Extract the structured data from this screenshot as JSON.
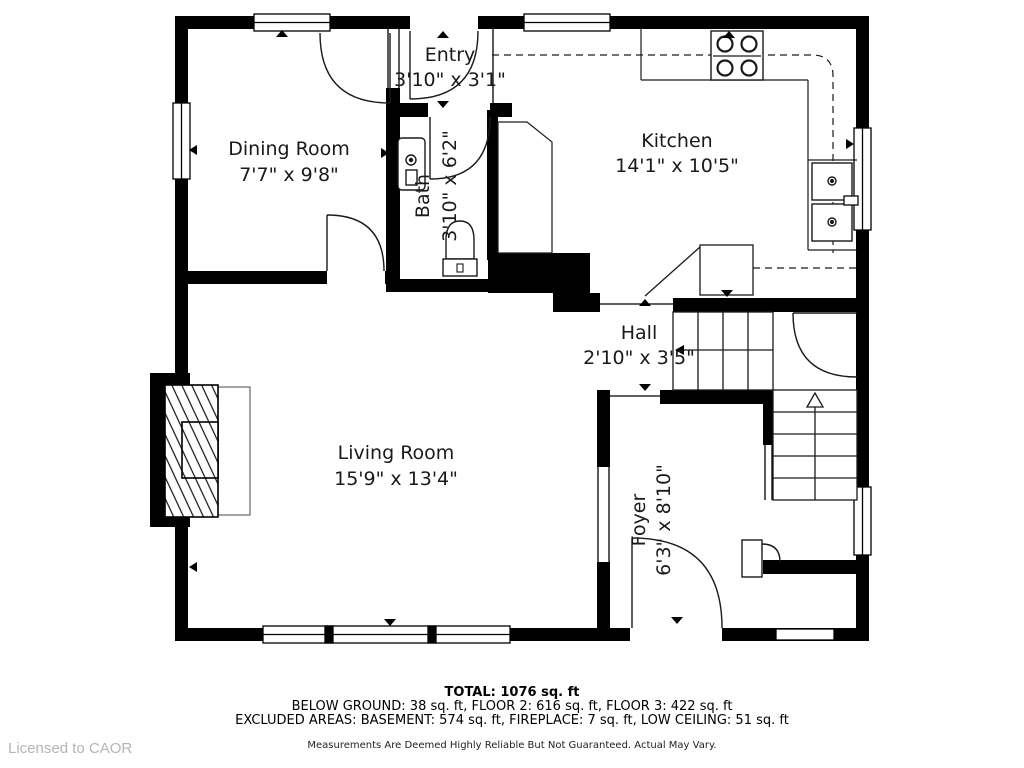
{
  "rooms": {
    "entry": {
      "name": "Entry",
      "dims": "3'10\" x 3'1\""
    },
    "dining": {
      "name": "Dining Room",
      "dims": "7'7\" x 9'8\""
    },
    "kitchen": {
      "name": "Kitchen",
      "dims": "14'1\" x 10'5\""
    },
    "bath": {
      "name": "Bath",
      "dims": "3'10\" x 6'2\""
    },
    "hall": {
      "name": "Hall",
      "dims": "2'10\" x 3'5\""
    },
    "living": {
      "name": "Living Room",
      "dims": "15'9\" x 13'4\""
    },
    "foyer": {
      "name": "Foyer",
      "dims": "6'3\" x 8'10\""
    }
  },
  "footer": {
    "total": "TOTAL: 1076 sq. ft",
    "breakdown": "BELOW GROUND: 38 sq. ft, FLOOR 2: 616 sq. ft, FLOOR 3: 422 sq. ft",
    "excluded": "EXCLUDED AREAS: BASEMENT: 574 sq. ft, FIREPLACE: 7 sq. ft, LOW CEILING: 51 sq. ft",
    "disclaimer": "Measurements Are Deemed Highly Reliable But Not Guaranteed. Actual May Vary."
  },
  "watermark": "Licensed to CAOR",
  "colors": {
    "wall": "#000000",
    "line": "#1a1a1a",
    "hearth": "#666666",
    "watermark": "#b5b5b5"
  }
}
